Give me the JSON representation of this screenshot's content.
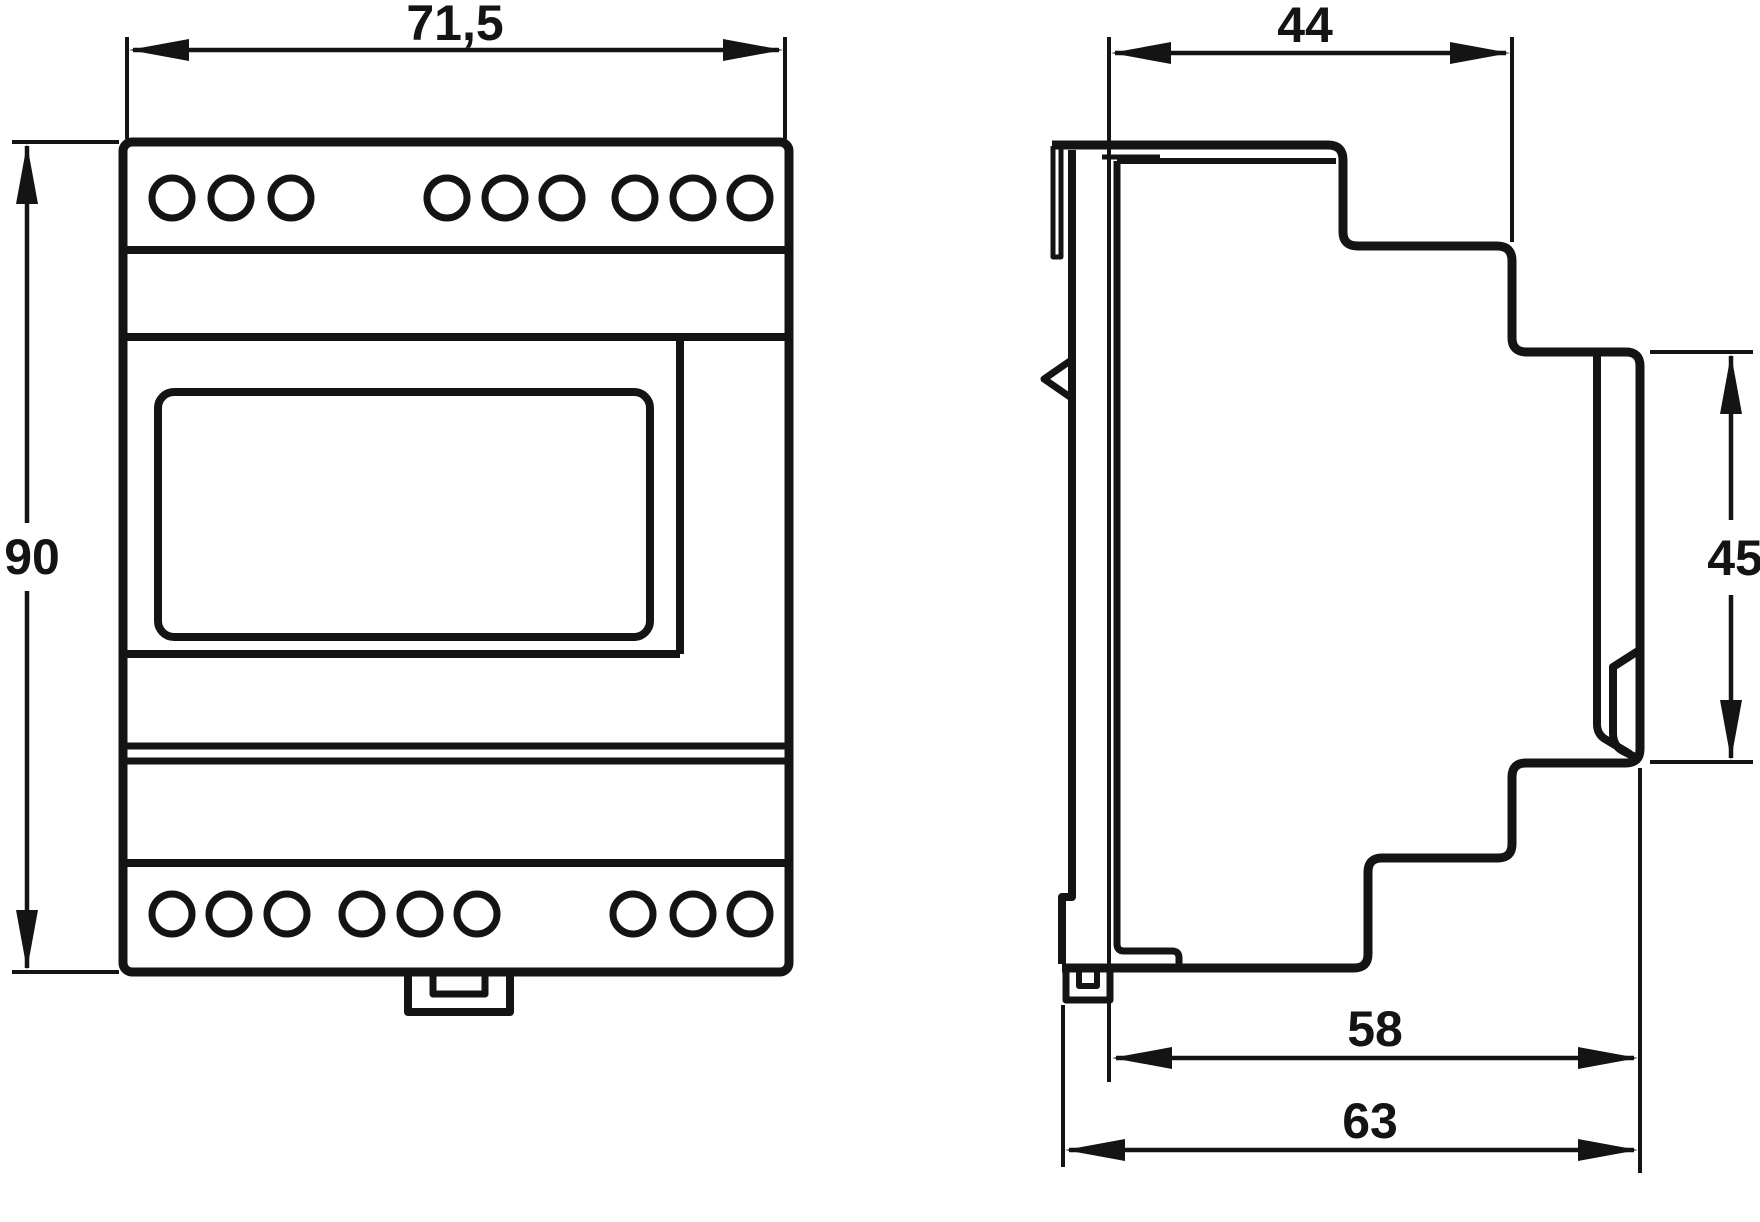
{
  "drawing": {
    "background": "#ffffff",
    "line_color": "#141414",
    "views": {
      "front": {
        "name": "front-view",
        "terminals_top_count": 9,
        "terminals_bottom_count": 9,
        "dim_width": {
          "label": "71,5",
          "value": 71.5
        },
        "dim_height": {
          "label": "90",
          "value": 90
        }
      },
      "side": {
        "name": "side-view",
        "dim_body_depth": {
          "label": "44",
          "value": 44
        },
        "dim_front_panel_height": {
          "label": "45",
          "value": 45
        },
        "dim_depth_to_step": {
          "label": "58",
          "value": 58
        },
        "dim_total_depth": {
          "label": "63",
          "value": 63
        }
      }
    }
  }
}
